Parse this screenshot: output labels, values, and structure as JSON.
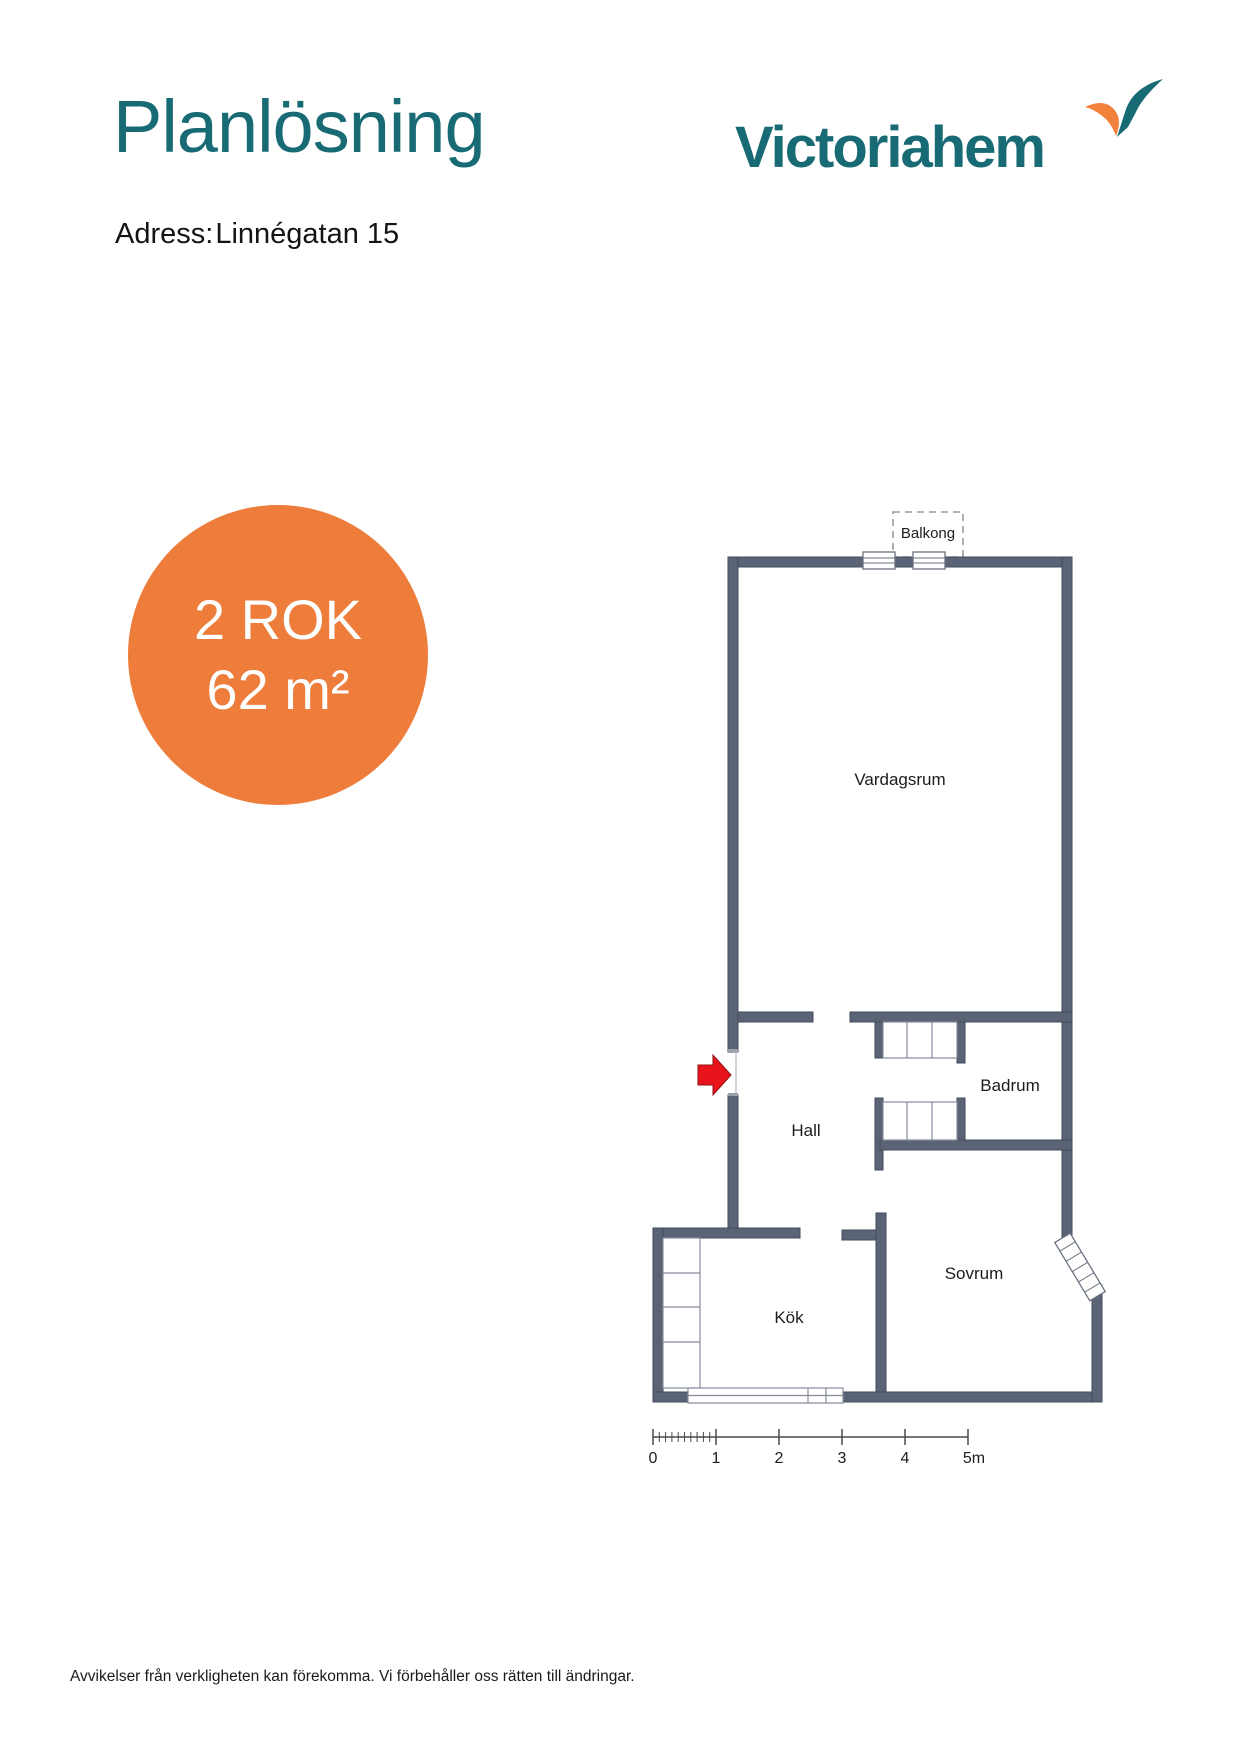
{
  "page": {
    "title": "Planlösning",
    "address_label": "Adress:",
    "address_value": "Linnégatan 15",
    "footer": "Avvikelser från verkligheten kan förekomma. Vi förbehåller oss rätten till ändringar."
  },
  "logo": {
    "text": "Victoriahem",
    "mark": "victoriahem-swoosh",
    "teal": "#186A74",
    "orange": "#F2823B"
  },
  "badge": {
    "line1": "2 ROK",
    "line2": "62 m²",
    "bg": "#EE7C3B",
    "text_color": "#FFFFFF"
  },
  "floorplan": {
    "wall_color": "#5A6476",
    "entrance_arrow_color": "#E8131B",
    "rooms": [
      {
        "name": "Balkong"
      },
      {
        "name": "Vardagsrum"
      },
      {
        "name": "Badrum"
      },
      {
        "name": "Hall"
      },
      {
        "name": "Kök"
      },
      {
        "name": "Sovrum"
      }
    ],
    "scale": {
      "labels": [
        "0",
        "1",
        "2",
        "3",
        "4",
        "5m"
      ]
    }
  }
}
